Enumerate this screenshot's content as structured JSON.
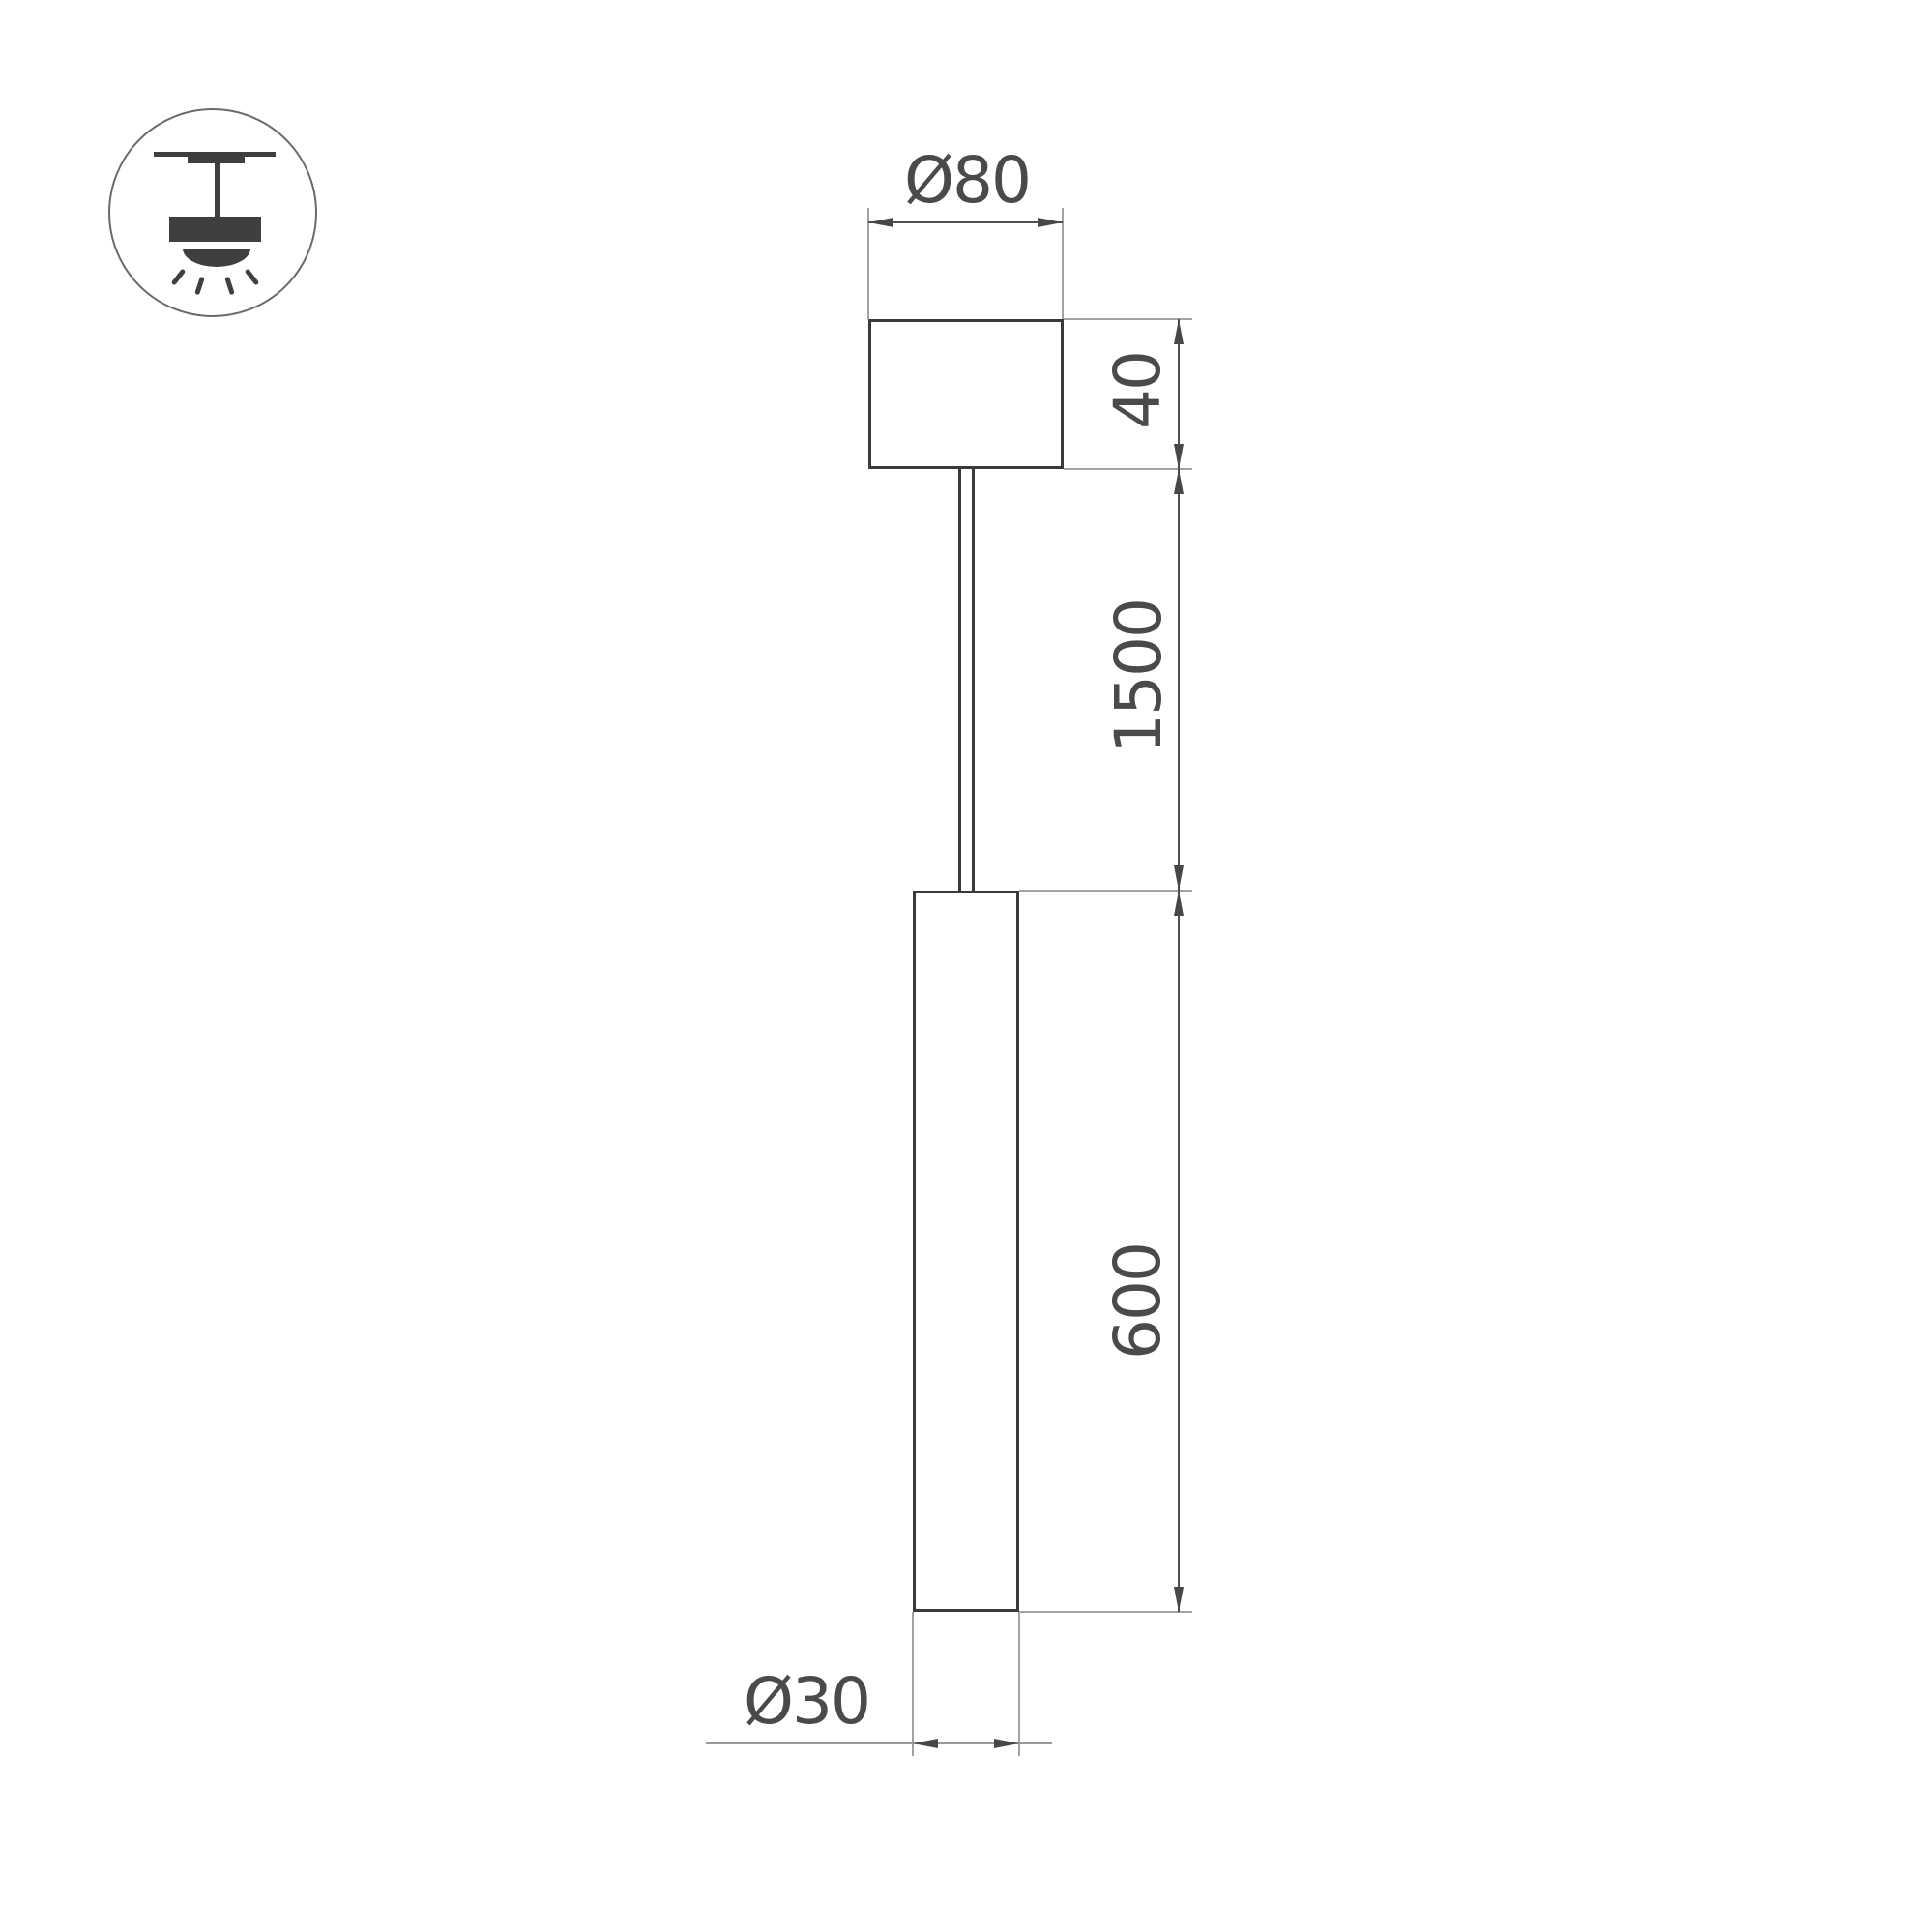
{
  "drawing": {
    "labels": {
      "canopy_diameter": "Ø80",
      "canopy_height": "40",
      "suspension_length": "1500",
      "tube_length": "600",
      "tube_diameter": "Ø30"
    },
    "icon": "ceiling-pendant-light",
    "colors": {
      "outline": "#3a3a3a",
      "extension_line": "#a2a2a2",
      "dimension_line": "#4f4f4f",
      "text": "#4a4a4a",
      "icon": "#3f3f3f",
      "background": "#ffffff"
    }
  }
}
